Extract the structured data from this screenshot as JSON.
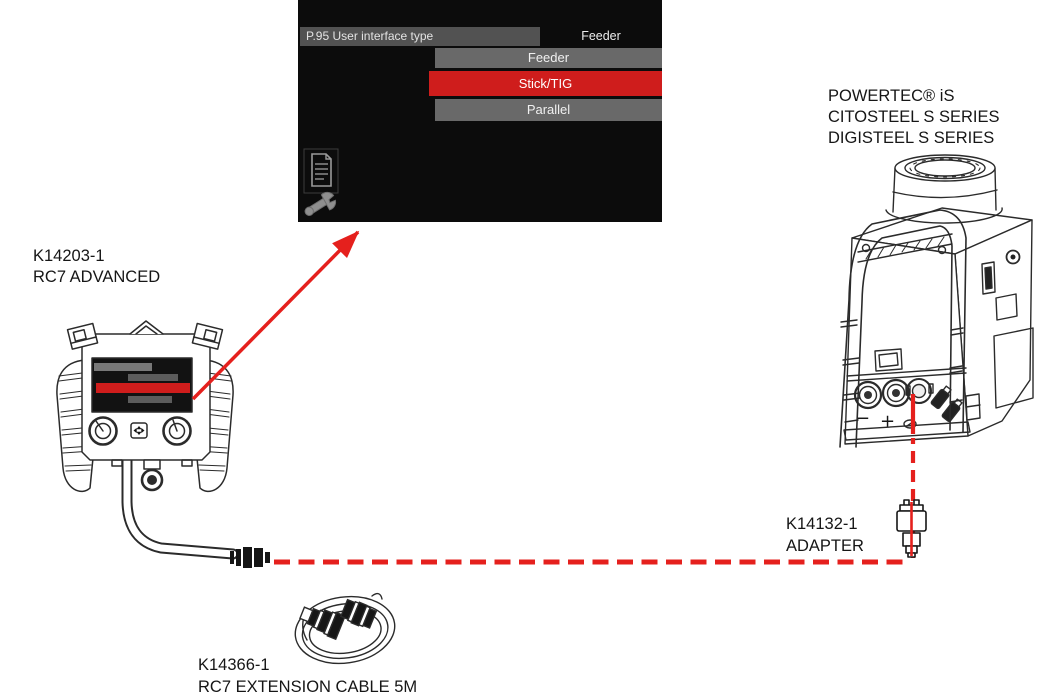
{
  "colors": {
    "accent_red": "#e5201d",
    "menu_selected_red": "#cf1d1c",
    "panel_bg": "#0c0c0c",
    "menu_row_gray": "#696969",
    "menu_header_gray": "#525252",
    "line_art": "#2b2b2b"
  },
  "menu_panel": {
    "parameter_label": "P.95 User interface type",
    "current_value": "Feeder",
    "options": [
      {
        "label": "Feeder",
        "selected": false
      },
      {
        "label": "Stick/TIG",
        "selected": true
      },
      {
        "label": "Parallel",
        "selected": false
      }
    ],
    "icons": [
      "document-icon",
      "wrench-icon"
    ]
  },
  "devices": {
    "remote": {
      "part_number": "K14203-1",
      "name": "RC7 ADVANCED"
    },
    "power_source": {
      "lines": [
        "POWERTEC® iS",
        "CITOSTEEL S SERIES",
        "DIGISTEEL S SERIES"
      ],
      "terminal_negative": "−",
      "terminal_positive": "+"
    },
    "adapter": {
      "part_number": "K14132-1",
      "name": "ADAPTER"
    },
    "extension_cable": {
      "part_number": "K14366-1",
      "name": "RC7 EXTENSION CABLE 5M"
    }
  }
}
